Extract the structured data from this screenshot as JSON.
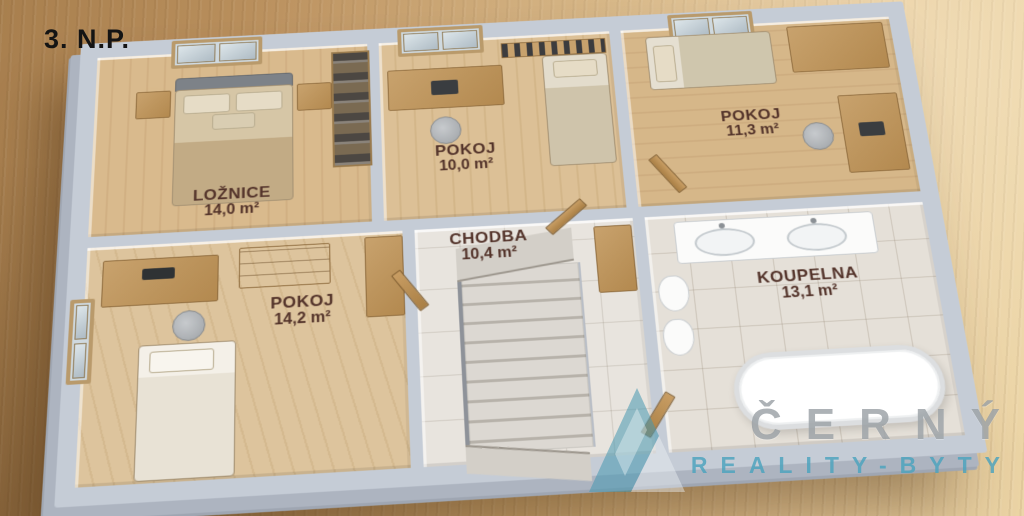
{
  "title": "3. N.P.",
  "plan": {
    "rooms": [
      {
        "name": "LOŽNICE",
        "area": "14,0 m²"
      },
      {
        "name": "POKOJ",
        "area": "10,0 m²"
      },
      {
        "name": "POKOJ",
        "area": "11,3 m²"
      },
      {
        "name": "POKOJ",
        "area": "14,2 m²"
      },
      {
        "name": "CHODBA",
        "area": "10,4 m²"
      },
      {
        "name": "KOUPELNA",
        "area": "13,1 m²"
      }
    ]
  },
  "watermark": {
    "brand": "ČERNÝ",
    "tagline": "REALITY-BYTY"
  },
  "colors": {
    "desk_wood_background": "#c49a66",
    "wall_gray": "#c5ccd6",
    "floor_wood": "#d8b88a",
    "floor_tile": "#e8e4de",
    "room_label_text": "#53332a",
    "title_text": "#141414",
    "watermark_gray": "#969ca2",
    "watermark_teal": "#4aa2bd"
  }
}
